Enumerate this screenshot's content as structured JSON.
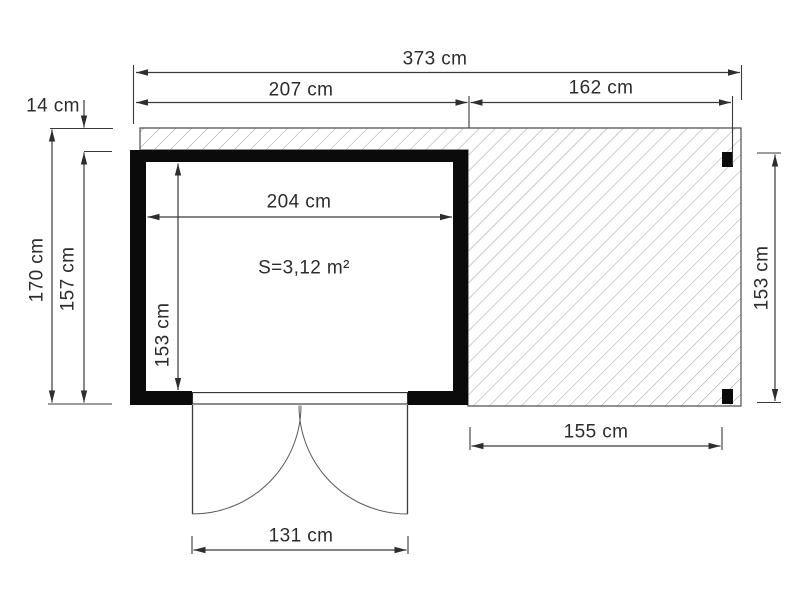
{
  "plan": {
    "area_label": "S=3,12 m²",
    "dims": {
      "total_width": "373 cm",
      "cabin_width": "207 cm",
      "canopy_width": "162 cm",
      "overhang": "14 cm",
      "total_depth": "170 cm",
      "cabin_depth": "157 cm",
      "inner_width": "204 cm",
      "inner_depth": "153 cm",
      "canopy_depth": "153 cm",
      "canopy_clear_width": "155 cm",
      "door_width": "131 cm"
    },
    "colors": {
      "wall": "#0b0b0b",
      "dimension_line": "#3a3a3a",
      "terrace_outline": "#4f4f4f",
      "hatch_line": "#a5a5a5",
      "text": "#2c2c2c",
      "background": "#ffffff"
    }
  }
}
